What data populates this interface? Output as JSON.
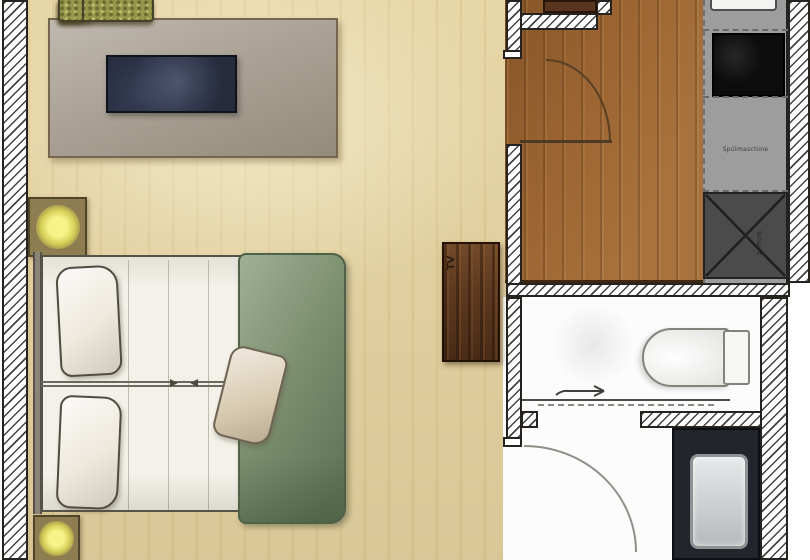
{
  "floorplan": {
    "title": "studio apartment floor plan",
    "labels": {
      "tv_unit": "TV",
      "dishwasher": "Spülmaschine",
      "shaft": "Schacht"
    },
    "colors": {
      "wood_light": "#ecdcad",
      "wood_dark": "#9c6533",
      "wall_fill": "#ffffff",
      "rug": "#aba295",
      "sofa_green": "#98984c",
      "table_navy": "#262b3d",
      "nightstand": "#8d7d51",
      "lamp_yellow": "#f5f282",
      "sheet_white": "#f3f1e9",
      "pillow_cream": "#eee9dd",
      "accent_pillow": "#d8cab0",
      "duvet_green": "#7d9070",
      "cabinet_brown": "#5e3a20",
      "door_brown": "#58361d",
      "counter_gray": "#9d9d9d",
      "cooktop_black": "#0c0c0c",
      "shaft_gray": "#4b4b4b",
      "bath_white": "#fcfcfc",
      "vanity_dark": "#22252c",
      "sink_gray": "#c9ccce"
    }
  }
}
